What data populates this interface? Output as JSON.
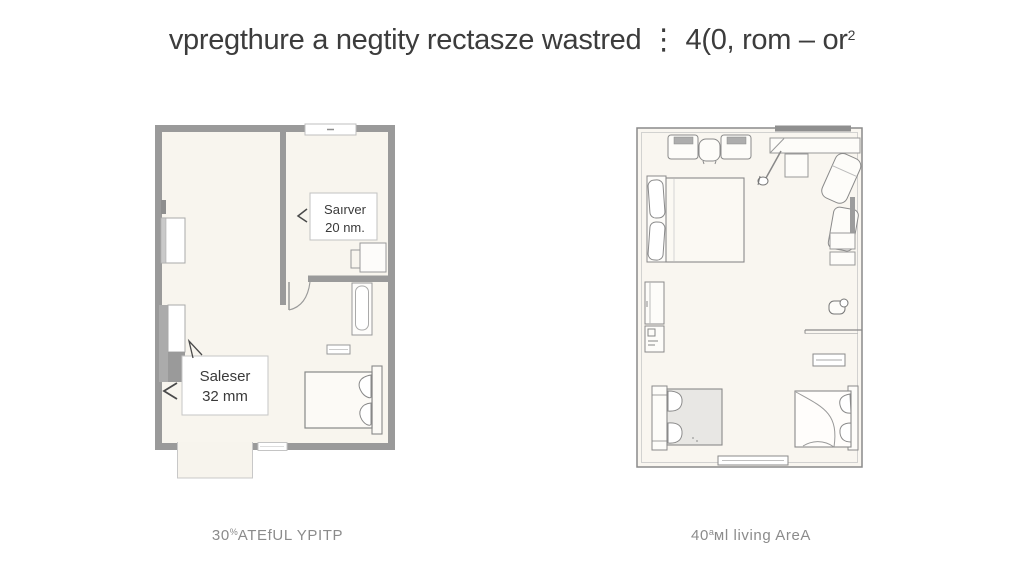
{
  "page": {
    "background": "#ffffff"
  },
  "title": {
    "text": "vpregthure a negtity rectasze wastred ⋮ 4(0, rom – or",
    "superscript": "2"
  },
  "left_plan": {
    "description": "thick-wall floor plan with small room, bathtub and bed",
    "wall_color": "#9a9a9a",
    "floor_color": "#f8f5ee",
    "labels": {
      "upper": {
        "line1": "Saırver",
        "line2": "20 nm."
      },
      "lower": {
        "line1": "Saleser",
        "line2": "32 mm"
      }
    },
    "caption": {
      "number": "30",
      "superscript": "%",
      "text": "ATEfUL YPITP"
    }
  },
  "right_plan": {
    "description": "thin-wall living area plan with sofas, desks and two beds",
    "wall_color": "#8a8a8a",
    "floor_color": "#f9f6f0",
    "caption": {
      "number": "40",
      "superscript": "a",
      "text": "ᴍl living AreA"
    }
  }
}
